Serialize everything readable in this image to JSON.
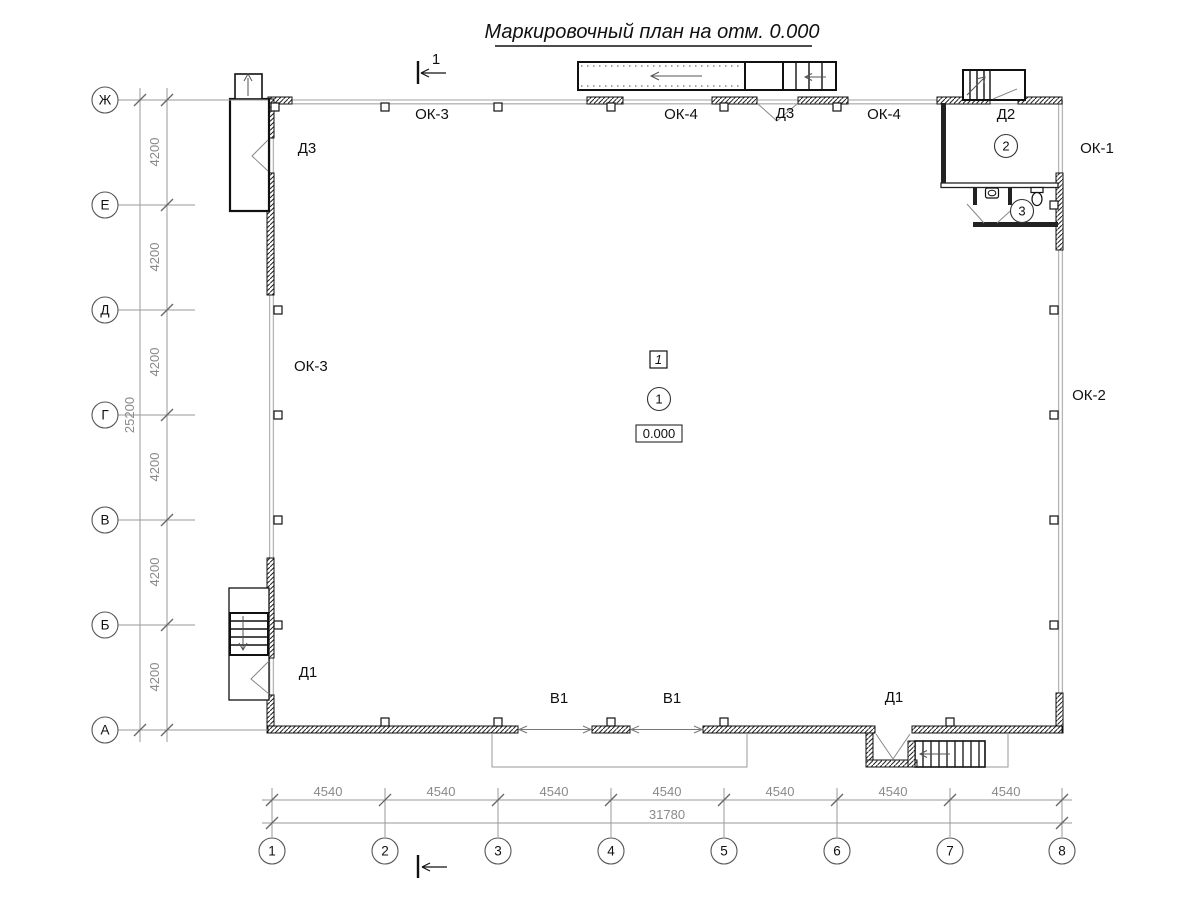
{
  "title": "Маркировочный план на отм. 0.000",
  "section_label": "1",
  "axes": {
    "rows": [
      "Ж",
      "Е",
      "Д",
      "Г",
      "В",
      "Б",
      "А"
    ],
    "cols": [
      "1",
      "2",
      "3",
      "4",
      "5",
      "6",
      "7",
      "8"
    ]
  },
  "dimensions": {
    "row_spans": [
      "4200",
      "4200",
      "4200",
      "4200",
      "4200",
      "4200"
    ],
    "row_total": "25200",
    "col_spans": [
      "4540",
      "4540",
      "4540",
      "4540",
      "4540",
      "4540",
      "4540"
    ],
    "col_total": "31780"
  },
  "markers": {
    "zone": "1",
    "elevation": "0.000"
  },
  "room_numbers": [
    "1",
    "2",
    "3"
  ],
  "labels": {
    "ok3_top": "ОК-3",
    "ok4_left": "ОК-4",
    "d3_top": "Д3",
    "ok4_right": "ОК-4",
    "d2": "Д2",
    "ok1": "ОК-1",
    "d3_left": "Д3",
    "ok3_left": "ОК-3",
    "ok2": "ОК-2",
    "d1_left": "Д1",
    "v1_left": "В1",
    "v1_right": "В1",
    "d1_right": "Д1"
  }
}
